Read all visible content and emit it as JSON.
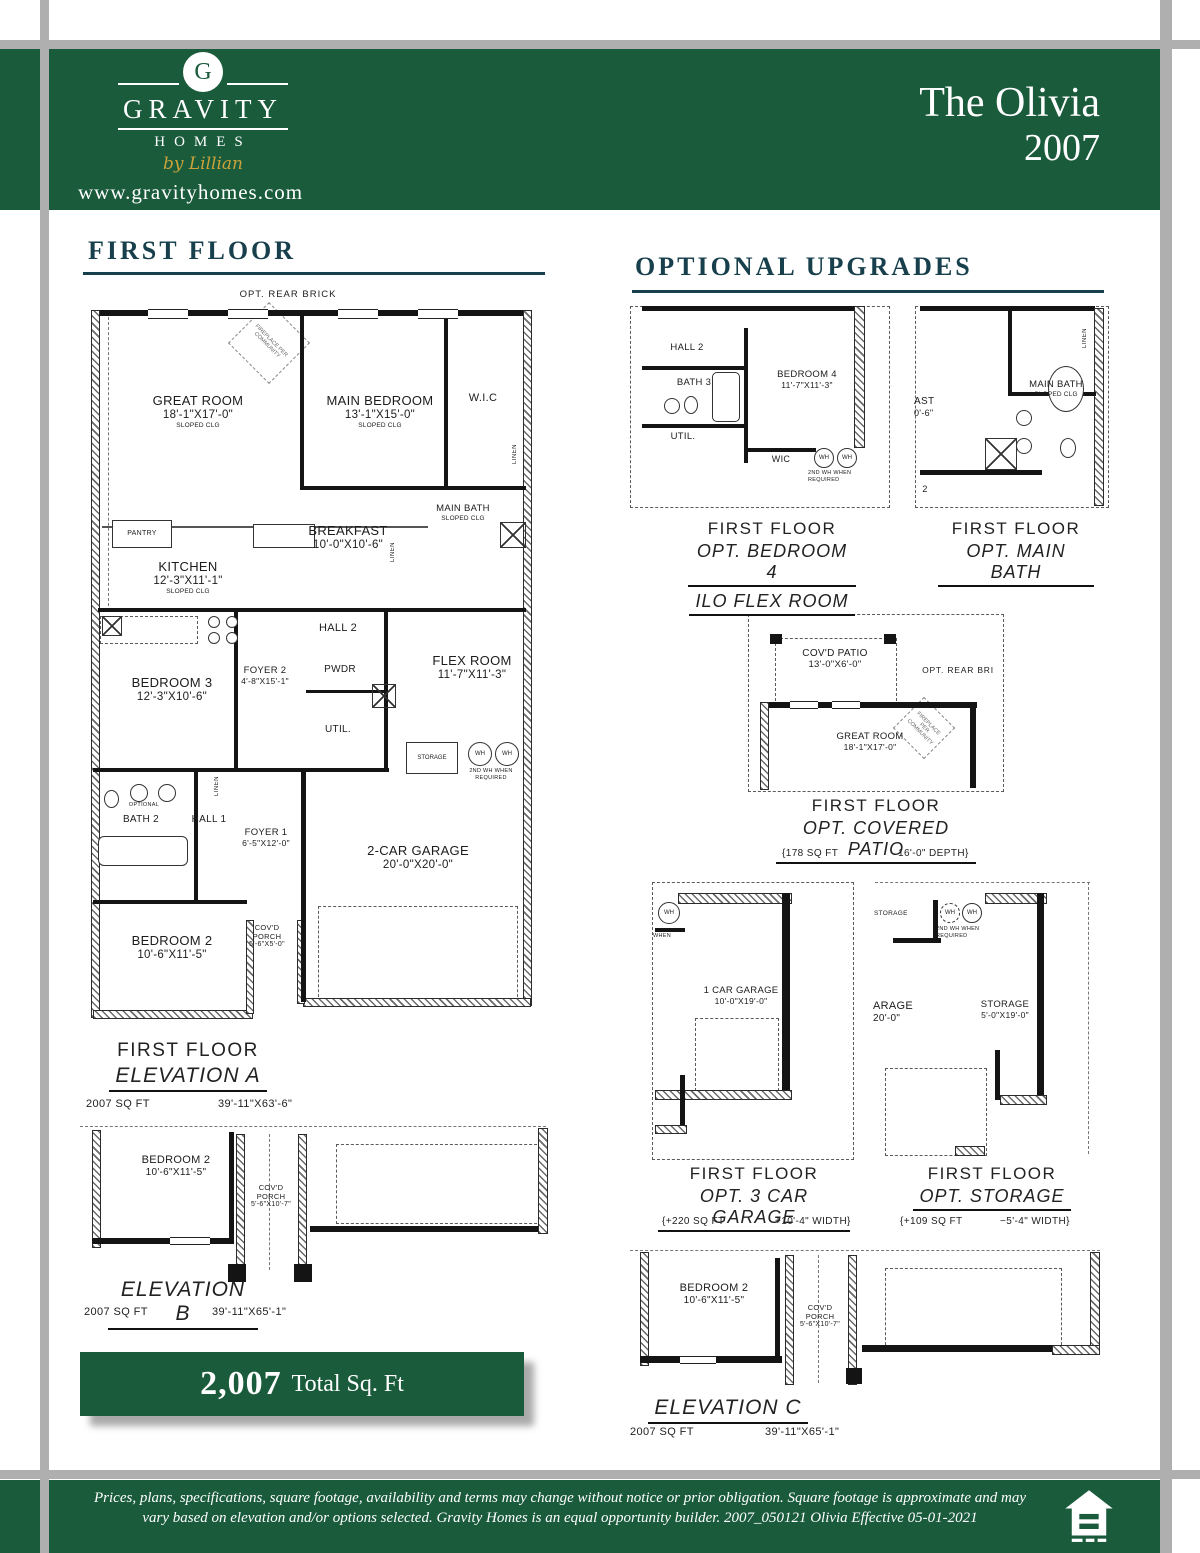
{
  "header": {
    "brand_initial": "G",
    "brand_name": "GRAVITY",
    "brand_homes": "HOMES",
    "brand_tagline": "by Lillian",
    "website": "www.gravityhomes.com",
    "plan_name": "The Olivia",
    "plan_year": "2007"
  },
  "colors": {
    "brand_green": "#1a5b3c",
    "heading_teal": "#173f4c",
    "gold": "#c9a23a",
    "bar_grey": "#b0afaf"
  },
  "ff": {
    "heading": "FIRST FLOOR",
    "plan": {
      "brick": "OPT. REAR BRICK",
      "fp": "FIREPLACE PER COMMUNITY",
      "gr": {
        "nm": "GREAT ROOM",
        "dims": "18'-1\"X17'-0\"",
        "note": "SLOPED CLG"
      },
      "mbr": {
        "nm": "MAIN BEDROOM",
        "dims": "13'-1\"X15'-0\"",
        "note": "SLOPED CLG"
      },
      "wic": "W.I.C",
      "linen": "LINEN",
      "pantry": "PANTRY",
      "kit": {
        "nm": "KITCHEN",
        "dims": "12'-3\"X11'-1\"",
        "note": "SLOPED CLG"
      },
      "bk": {
        "nm": "BREAKFAST",
        "dims": "10'-0\"X10'-6\""
      },
      "mbath": {
        "nm": "MAIN BATH",
        "note": "SLOPED CLG"
      },
      "hall2": "HALL 2",
      "foyer2": {
        "nm": "FOYER 2",
        "dims": "4'-8\"X15'-1\""
      },
      "pwdr": "PWDR",
      "flex": {
        "nm": "FLEX ROOM",
        "dims": "11'-7\"X11'-3\""
      },
      "bed3": {
        "nm": "BEDROOM 3",
        "dims": "12'-3\"X10'-6\""
      },
      "util": "UTIL.",
      "storage": "STORAGE",
      "wh": "WH",
      "whnote": "2ND WH WHEN REQUIRED",
      "optional": "OPTIONAL",
      "bath2": "BATH 2",
      "hall1": "HALL 1",
      "foyer1": {
        "nm": "FOYER 1",
        "dims": "6'-5\"X12'-0\""
      },
      "gar": {
        "nm": "2-CAR GARAGE",
        "dims": "20'-0\"X20'-0\""
      },
      "bed2": {
        "nm": "BEDROOM 2",
        "dims": "10'-6\"X11'-5\""
      },
      "porch": {
        "nm": "COV'D",
        "nm2": "PORCH",
        "dims": "5'-6\"X5'-0\""
      }
    },
    "elevA": {
      "l1": "FIRST FLOOR",
      "l2": "ELEVATION A",
      "sqft": "2007 SQ FT",
      "dims": "39'-11\"X63'-6\""
    },
    "elevB": {
      "label": "ELEVATION B",
      "sqft": "2007 SQ FT",
      "dims": "39'-11\"X65'-1\"",
      "bed2": {
        "nm": "BEDROOM 2",
        "dims": "10'-6\"X11'-5\""
      },
      "porch": {
        "nm": "COV'D",
        "nm2": "PORCH",
        "dims": "5'-6\"X10'-7\""
      }
    },
    "total": {
      "value": "2,007",
      "label": "Total Sq. Ft"
    }
  },
  "up": {
    "heading": "OPTIONAL UPGRADES",
    "b4": {
      "plan": {
        "hall2": "HALL 2",
        "bath3": "BATH 3",
        "nm": "BEDROOM 4",
        "dims": "11'-7\"X11'-3\"",
        "util": "UTIL.",
        "wic": "WIC",
        "wh": "WH",
        "whnote": "2ND WH WHEN REQUIRED"
      },
      "cap": {
        "l1": "FIRST FLOOR",
        "l2": "OPT. BEDROOM 4",
        "l3": "ILO FLEX ROOM"
      }
    },
    "mb": {
      "plan": {
        "ast": "AST",
        "astdims": "0'-6\"",
        "nm": "MAIN BATH",
        "note": "SLOPED CLG",
        "linen": "LINEN",
        "hallfrag": "2"
      },
      "cap": {
        "l1": "FIRST FLOOR",
        "l2": "OPT. MAIN BATH"
      }
    },
    "cp": {
      "plan": {
        "patio_nm": "COV'D PATIO",
        "patio_dims": "13'-0\"X6'-0\"",
        "brick": "OPT. REAR BRI",
        "gr_nm": "GREAT ROOM",
        "gr_dims": "18'-1\"X17'-0\"",
        "fp": "FIREPLACE PER COMMUNITY"
      },
      "cap": {
        "l1": "FIRST FLOOR",
        "l2": "OPT. COVERED PATIO",
        "s1": "{178 SQ FT",
        "s2": "16'-0\" DEPTH}"
      }
    },
    "g3": {
      "plan": {
        "wh": "WH",
        "when": "WHEN",
        "nm": "1 CAR GARAGE",
        "dims": "10'-0\"X19'-0\""
      },
      "cap": {
        "l1": "FIRST FLOOR",
        "l2": "OPT. 3 CAR GARAGE",
        "s1": "{+220 SQ FT",
        "s2": "+10'-4\" WIDTH}"
      }
    },
    "st": {
      "plan": {
        "small": "STORAGE",
        "wh": "WH",
        "whnote": "2ND WH WHEN REQUIRED",
        "gar_nm": "ARAGE",
        "gar_dims": "20'-0\"",
        "nm": "STORAGE",
        "dims": "5'-0\"X19'-0\""
      },
      "cap": {
        "l1": "FIRST FLOOR",
        "l2": "OPT. STORAGE",
        "s1": "{+109 SQ FT",
        "s2": "−5'-4\" WIDTH}"
      }
    },
    "elevC": {
      "label": "ELEVATION C",
      "sqft": "2007 SQ FT",
      "dims": "39'-11\"X65'-1\"",
      "bed2nm": "BEDROOM 2",
      "bed2dims": "10'-6\"X11'-5\"",
      "porchnm": "COV'D",
      "porchnm2": "PORCH",
      "porchdims": "5'-6\"X10'-7\""
    }
  },
  "footer": {
    "line1": "Prices, plans, specifications, square footage, availability and terms may change without notice or prior obligation. Square footage is approximate and may",
    "line2": "vary based on elevation and/or options selected. Gravity Homes is an equal opportunity builder. 2007_050121 Olivia Effective 05-01-2021"
  }
}
